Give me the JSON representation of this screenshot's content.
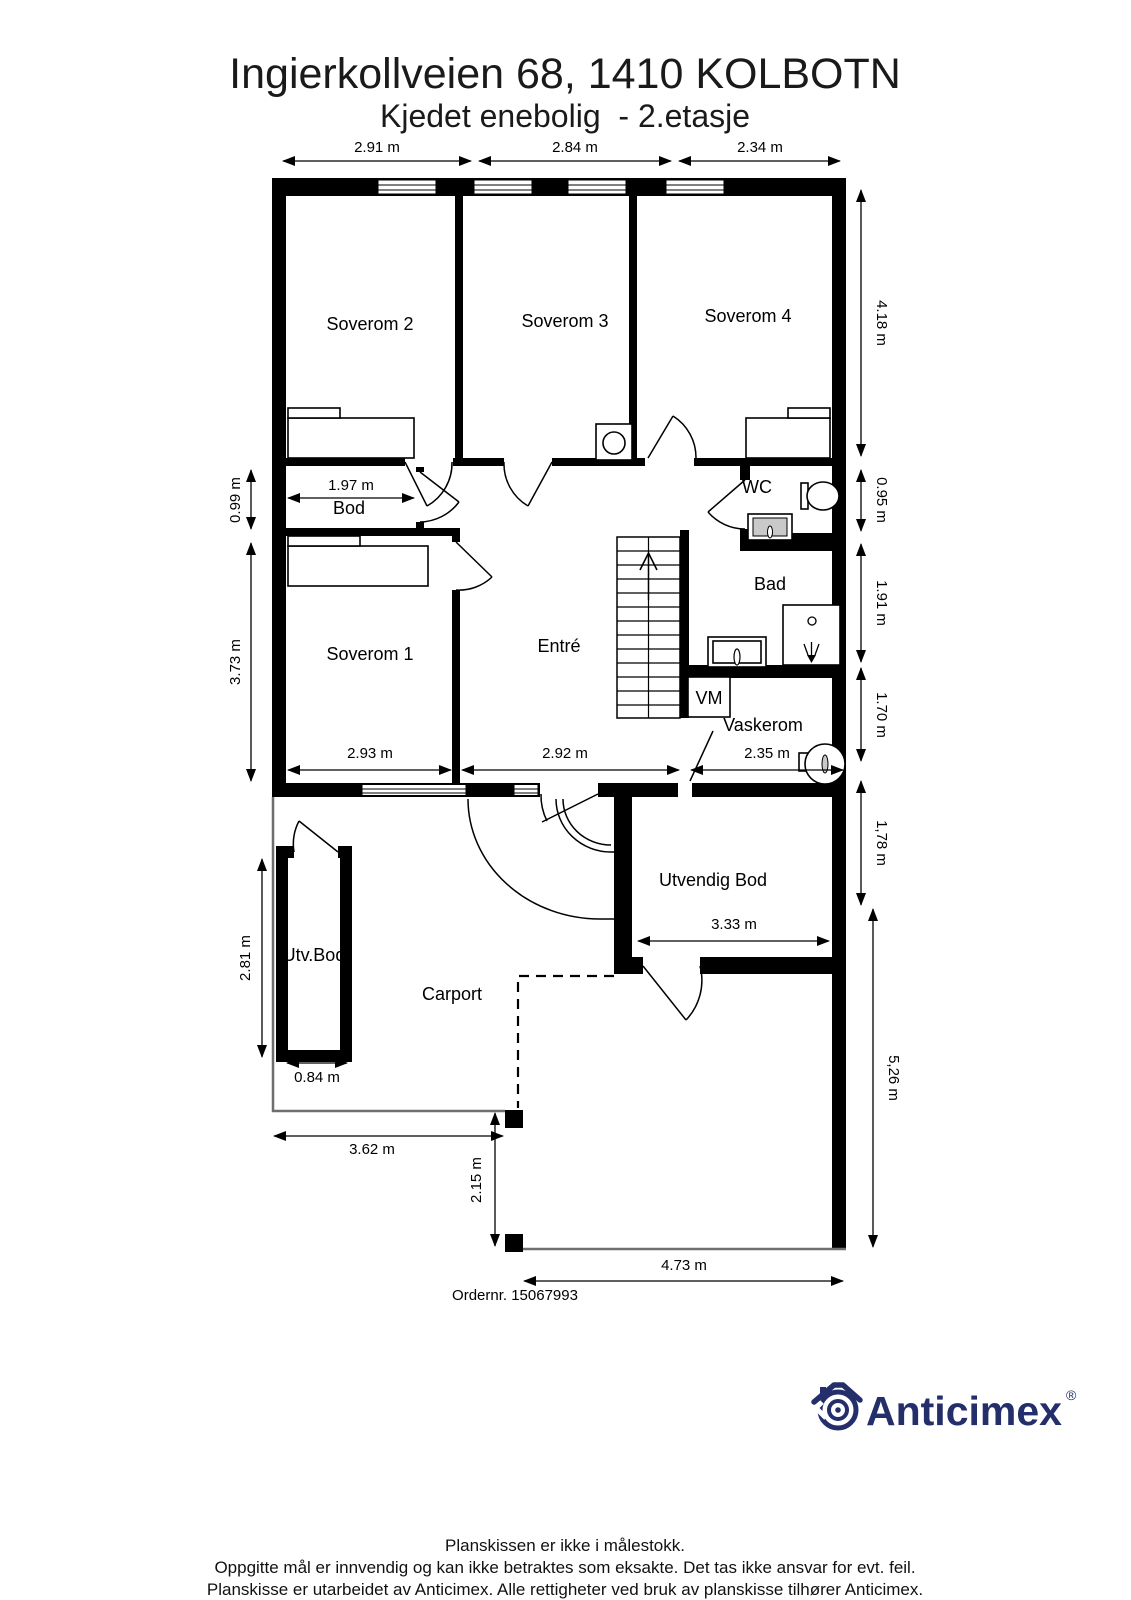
{
  "header": {
    "title": "Ingierkollveien 68, 1410 KOLBOTN",
    "subtitle": "Kjedet enebolig  - 2.etasje"
  },
  "rooms": {
    "soverom1": "Soverom 1",
    "soverom2": "Soverom 2",
    "soverom3": "Soverom 3",
    "soverom4": "Soverom 4",
    "bod": "Bod",
    "entre": "Entré",
    "wc": "WC",
    "bad": "Bad",
    "vm": "VM",
    "vaskerom": "Vaskerom",
    "utvendig_bod": "Utvendig Bod",
    "utv_bod": "Utv.Bod",
    "carport": "Carport"
  },
  "dims": {
    "w_sov2": "2.91 m",
    "w_sov3": "2.84 m",
    "w_sov4": "2.34 m",
    "h_sov4": "4.18 m",
    "h_wc": "0.95 m",
    "h_bad": "1.91 m",
    "h_vaskerom": "1.70 m",
    "h_utvendig_bod": "1,78 m",
    "h_carport": "5,26 m",
    "h_bod": "0.99 m",
    "h_sov1": "3.73 m",
    "h_utv_bod": "2.81 m",
    "w_bod": "1.97 m",
    "w_sov1": "2.93 m",
    "w_entre": "2.92 m",
    "w_vaskerom": "2.35 m",
    "w_utvendig_bod": "3.33 m",
    "w_utv_bod": "0.84 m",
    "w_carport": "3.62 m",
    "h_carport_open": "2.15 m",
    "w_bottom": "4.73 m"
  },
  "order_number": "Ordernr. 15067993",
  "logo": {
    "text": "Anticimex",
    "registered": "®",
    "color": "#232e6a"
  },
  "footer": {
    "line1": "Planskissen er ikke i målestokk.",
    "line2": "Oppgitte mål er innvendig og kan ikke betraktes som eksakte. Det tas ikke ansvar for evt. feil.",
    "line3": "Planskisse er utarbeidet av Anticimex. Alle rettigheter ved bruk av planskisse tilhører Anticimex."
  },
  "icons": {
    "staircase": "staircase-up",
    "toilet": "toilet",
    "wc_sink": "sink",
    "bad_sink": "vanity-sink",
    "shower": "shower-head",
    "washing_machine": "washing-machine",
    "laundry_sink": "round-sink",
    "basin": "basin"
  }
}
